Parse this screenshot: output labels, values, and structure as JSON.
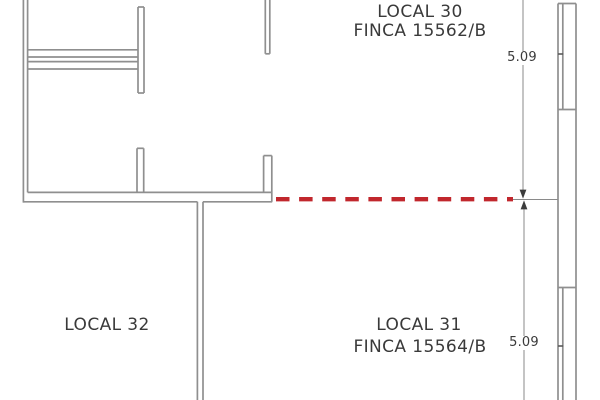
{
  "plan": {
    "title": "Floor plan with property boundary",
    "units": [
      {
        "name": "LOCAL 30",
        "finca": "FINCA 15562/B"
      },
      {
        "name": "LOCAL 31",
        "finca": "FINCA 15564/B"
      },
      {
        "name": "LOCAL 32",
        "finca": ""
      }
    ],
    "dimensions": [
      {
        "value": "5.09",
        "position": "top-right"
      },
      {
        "value": "5.09",
        "position": "bottom-right"
      }
    ],
    "colors": {
      "wall": "#8f8f8f",
      "tick": "#5a5a5a",
      "dimension": "#8a8a8a",
      "arrow": "#3c3c3c",
      "text": "#3a3a3a",
      "red_boundary": "#c1272d",
      "background": "#ffffff"
    }
  }
}
